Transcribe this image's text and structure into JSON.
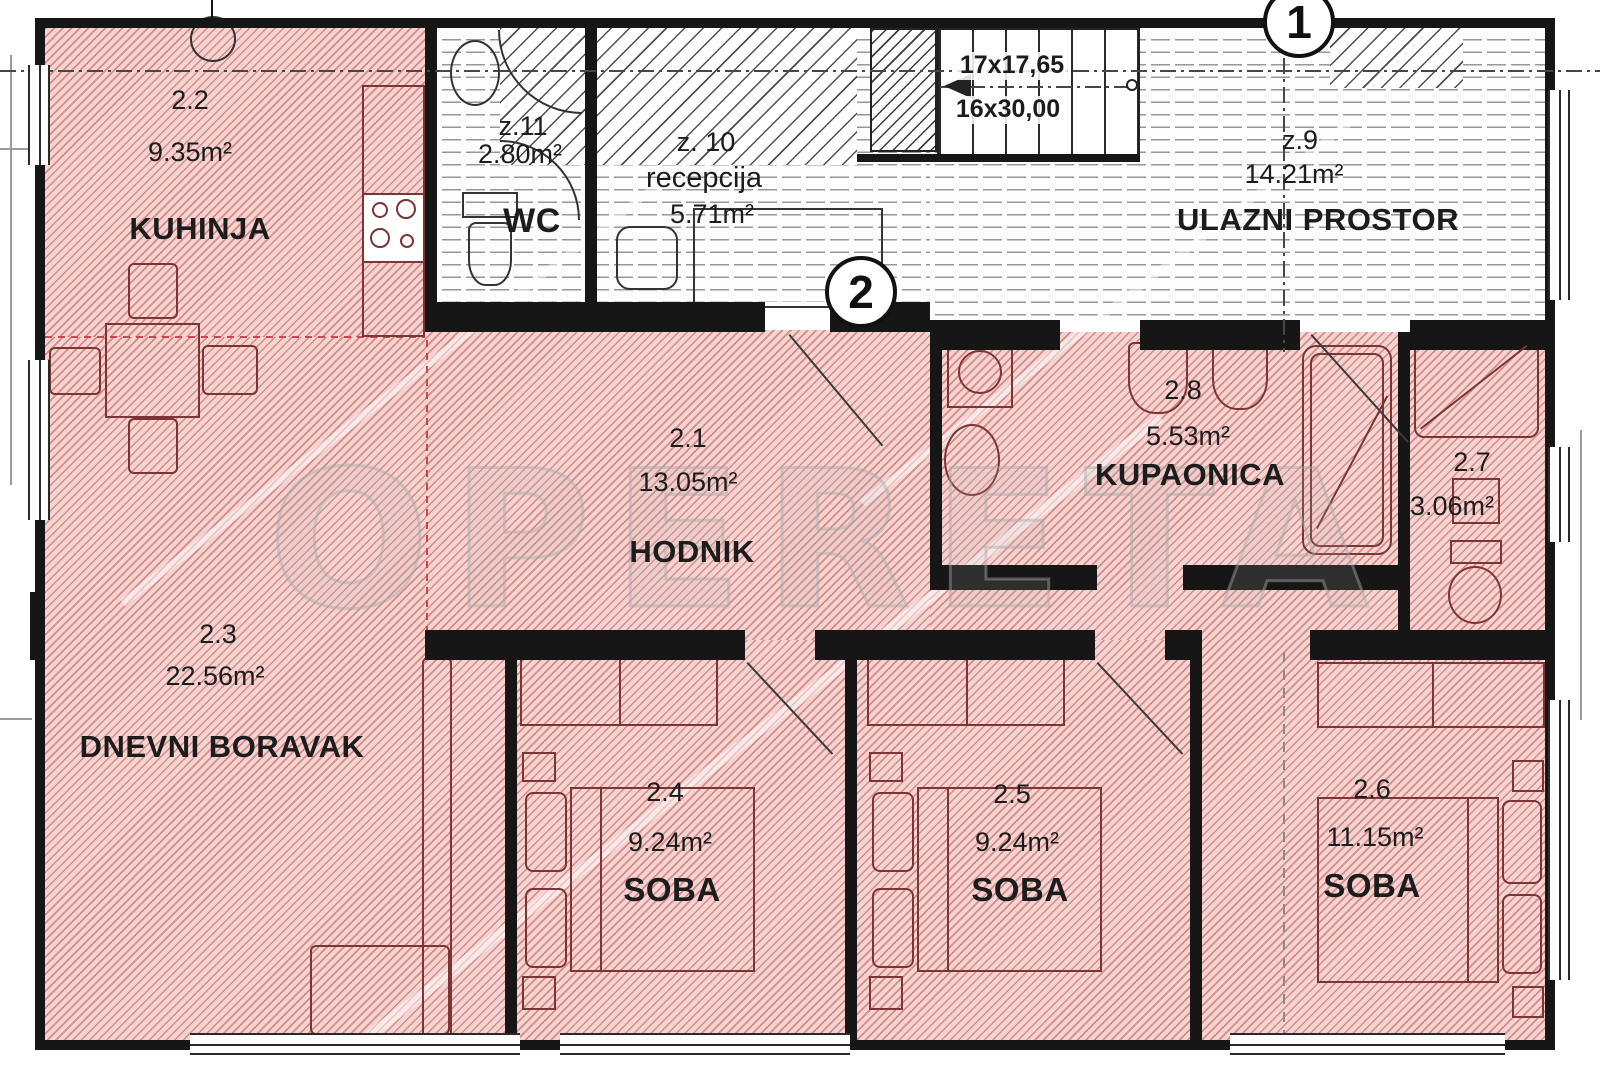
{
  "watermark": "OPERETA",
  "markers": {
    "m1": "1",
    "m2": "2"
  },
  "stairs": {
    "run1": "17x17,65",
    "run2": "16x30,00"
  },
  "rooms": {
    "kuhinja": {
      "id": "2.2",
      "area": "9.35m²",
      "name": "KUHINJA"
    },
    "wc": {
      "id": "z.11",
      "area": "2.80m²",
      "name": "WC"
    },
    "recepcija": {
      "id": "z. 10",
      "name": "recepcija",
      "area": "5.71m²"
    },
    "ulazni": {
      "id": "z.9",
      "area": "14.21m²",
      "name": "ULAZNI PROSTOR"
    },
    "hodnik": {
      "id": "2.1",
      "area": "13.05m²",
      "name": "HODNIK"
    },
    "kupaonica": {
      "id": "2.8",
      "area": "5.53m²",
      "name": "KUPAONICA"
    },
    "wc2": {
      "id": "2.7",
      "area": "3.06m²"
    },
    "dnevni": {
      "id": "2.3",
      "area": "22.56m²",
      "name": "DNEVNI BORAVAK"
    },
    "soba1": {
      "id": "2.4",
      "area": "9.24m²",
      "name": "SOBA"
    },
    "soba2": {
      "id": "2.5",
      "area": "9.24m²",
      "name": "SOBA"
    },
    "soba3": {
      "id": "2.6",
      "area": "11.15m²",
      "name": "SOBA"
    }
  },
  "colors": {
    "apartment_hatch_fill": "#f5d3d1",
    "apartment_hatch_line": "#ba504c",
    "wall": "#161616",
    "furniture_outline": "#7c3434"
  }
}
